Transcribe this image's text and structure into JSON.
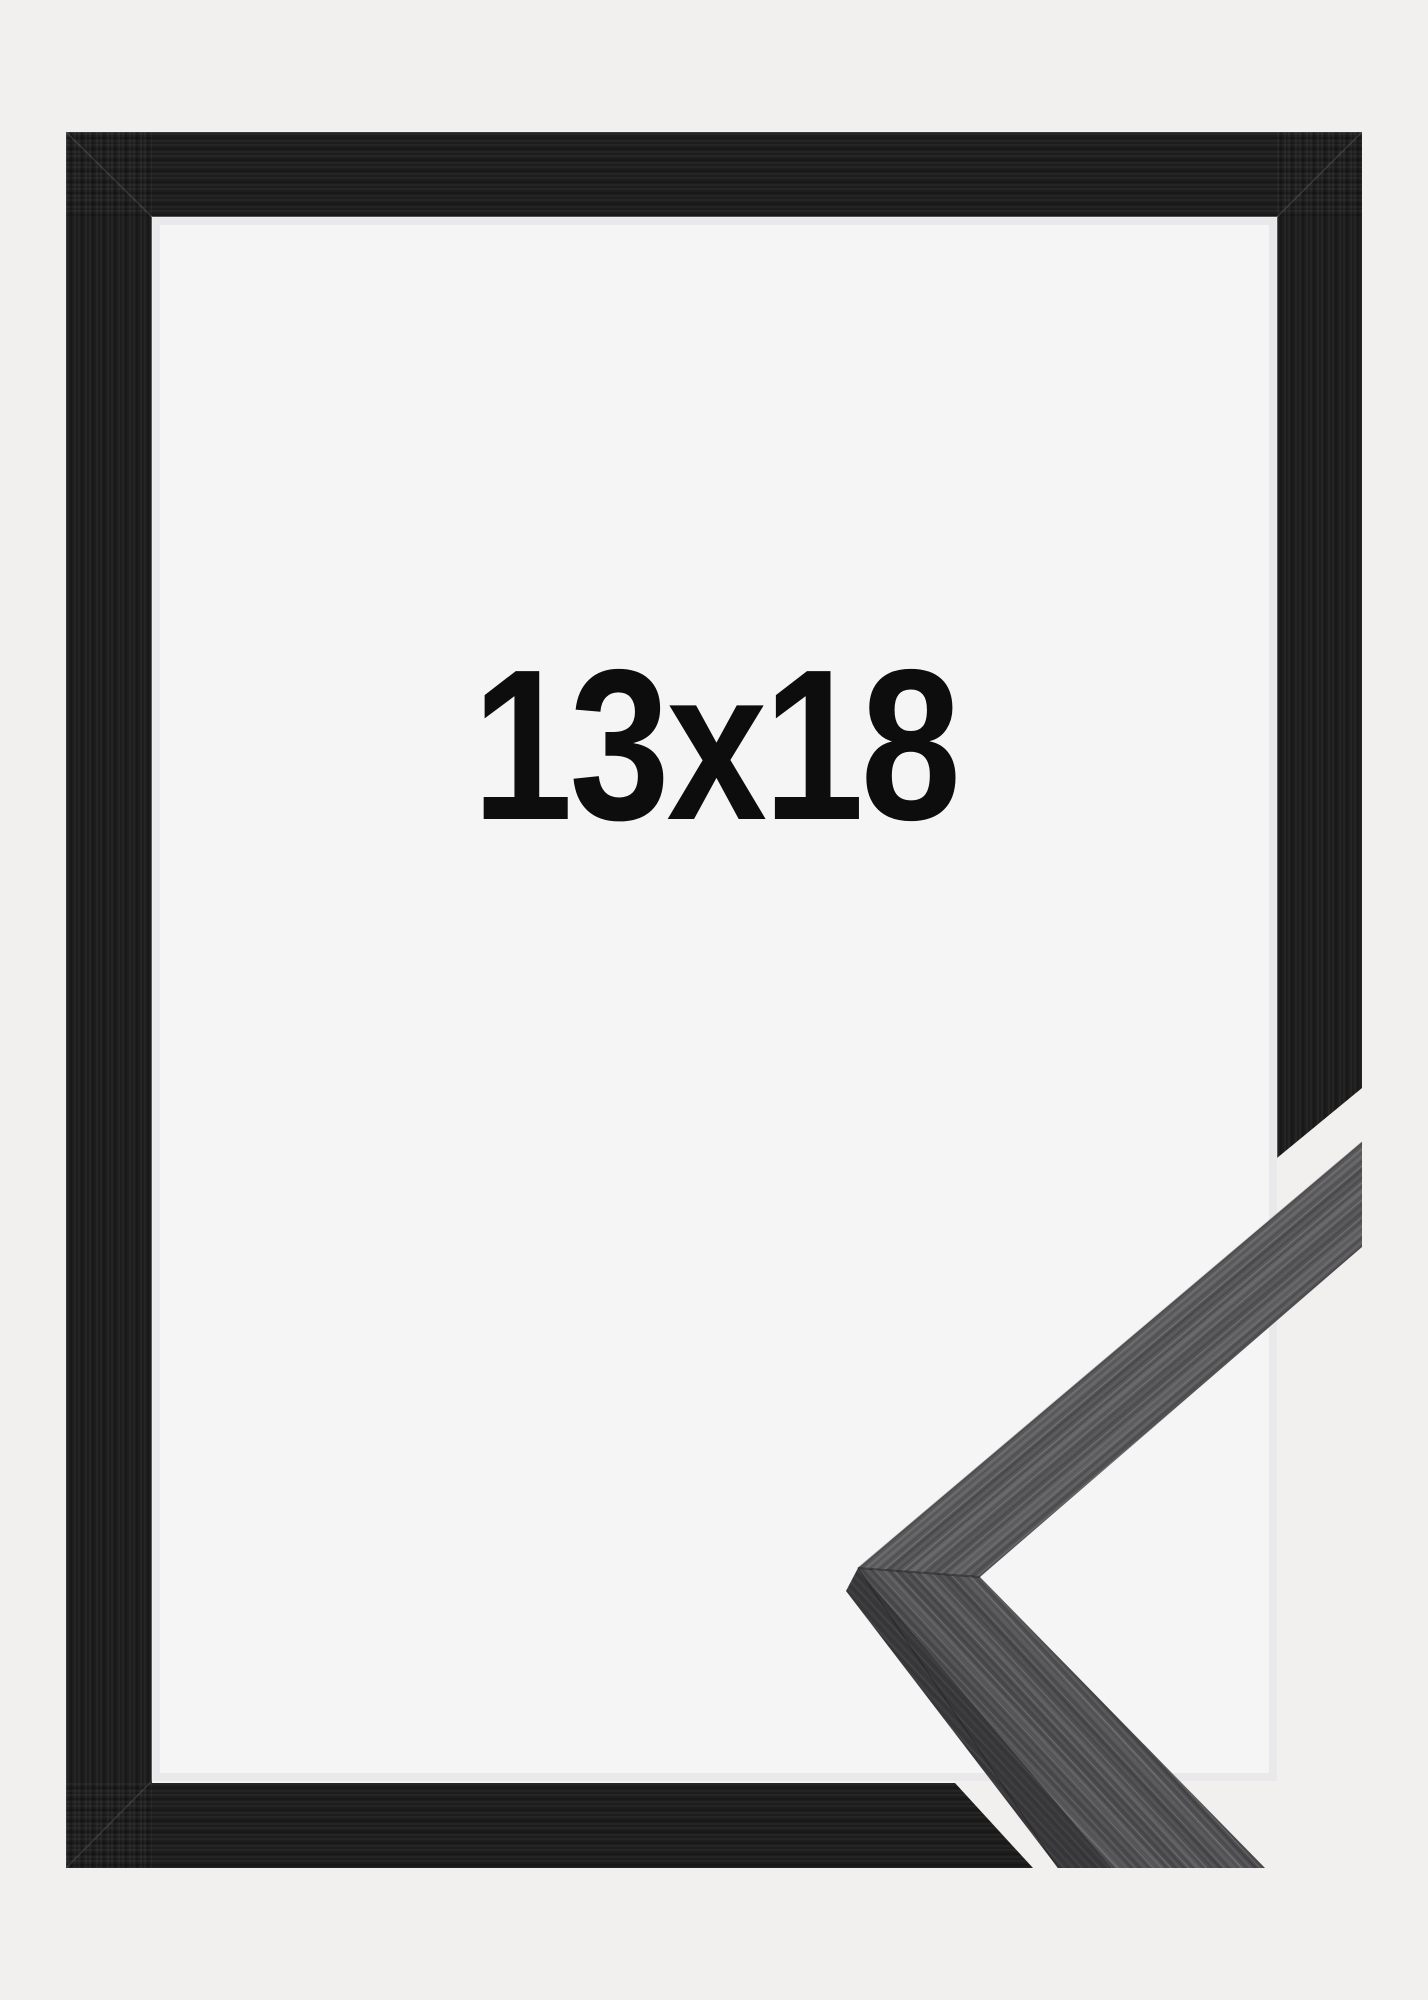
{
  "product_image": {
    "description": "black wooden picture frame with moulding corner sample",
    "size_label": "13x18"
  },
  "colors": {
    "background": "#f1f0ef",
    "interior": "#f5f5f6",
    "frame_black": "#1d1d1e",
    "sample_wood_upper": "#58585a",
    "sample_wood_lower": "#505052",
    "sample_wood_side": "#38383a",
    "label_color": "#0d0d0d"
  }
}
